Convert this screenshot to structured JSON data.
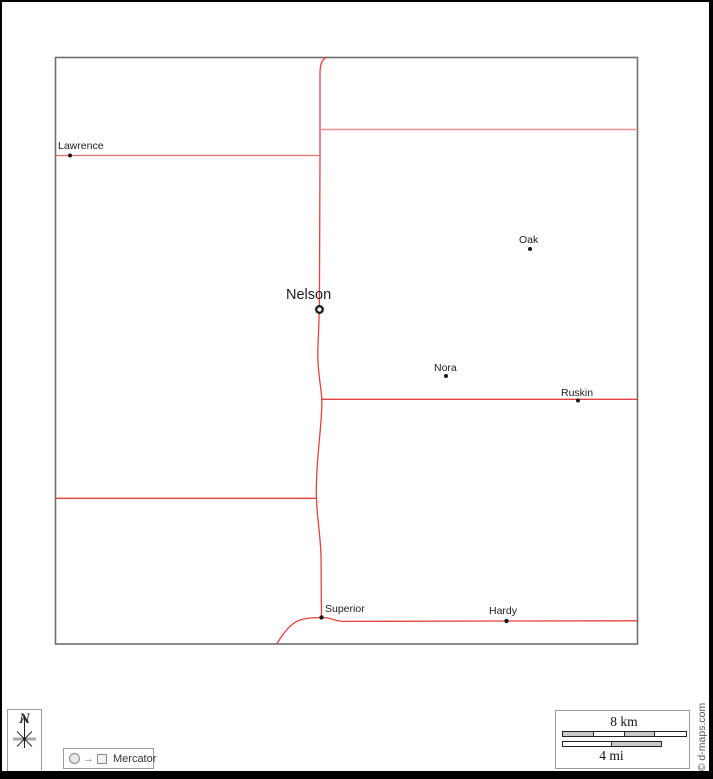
{
  "map": {
    "towns": [
      {
        "name": "Lawrence",
        "marker": "dot"
      },
      {
        "name": "Oak",
        "marker": "dot"
      },
      {
        "name": "Nelson",
        "marker": "county-seat-ring"
      },
      {
        "name": "Nora",
        "marker": "dot"
      },
      {
        "name": "Ruskin",
        "marker": "dot"
      },
      {
        "name": "Superior",
        "marker": "dot"
      },
      {
        "name": "Hardy",
        "marker": "dot"
      }
    ],
    "colors": {
      "road": "#e84040",
      "road_light": "#f29090",
      "map_border": "#6e6e6e",
      "town_dot": "#1a1a1a"
    }
  },
  "compass": {
    "label": "N"
  },
  "projection": {
    "label": "Mercator"
  },
  "scale": {
    "km_label": "8 km",
    "mi_label": "4 mi"
  },
  "credit": {
    "text": "© d-maps.com"
  }
}
